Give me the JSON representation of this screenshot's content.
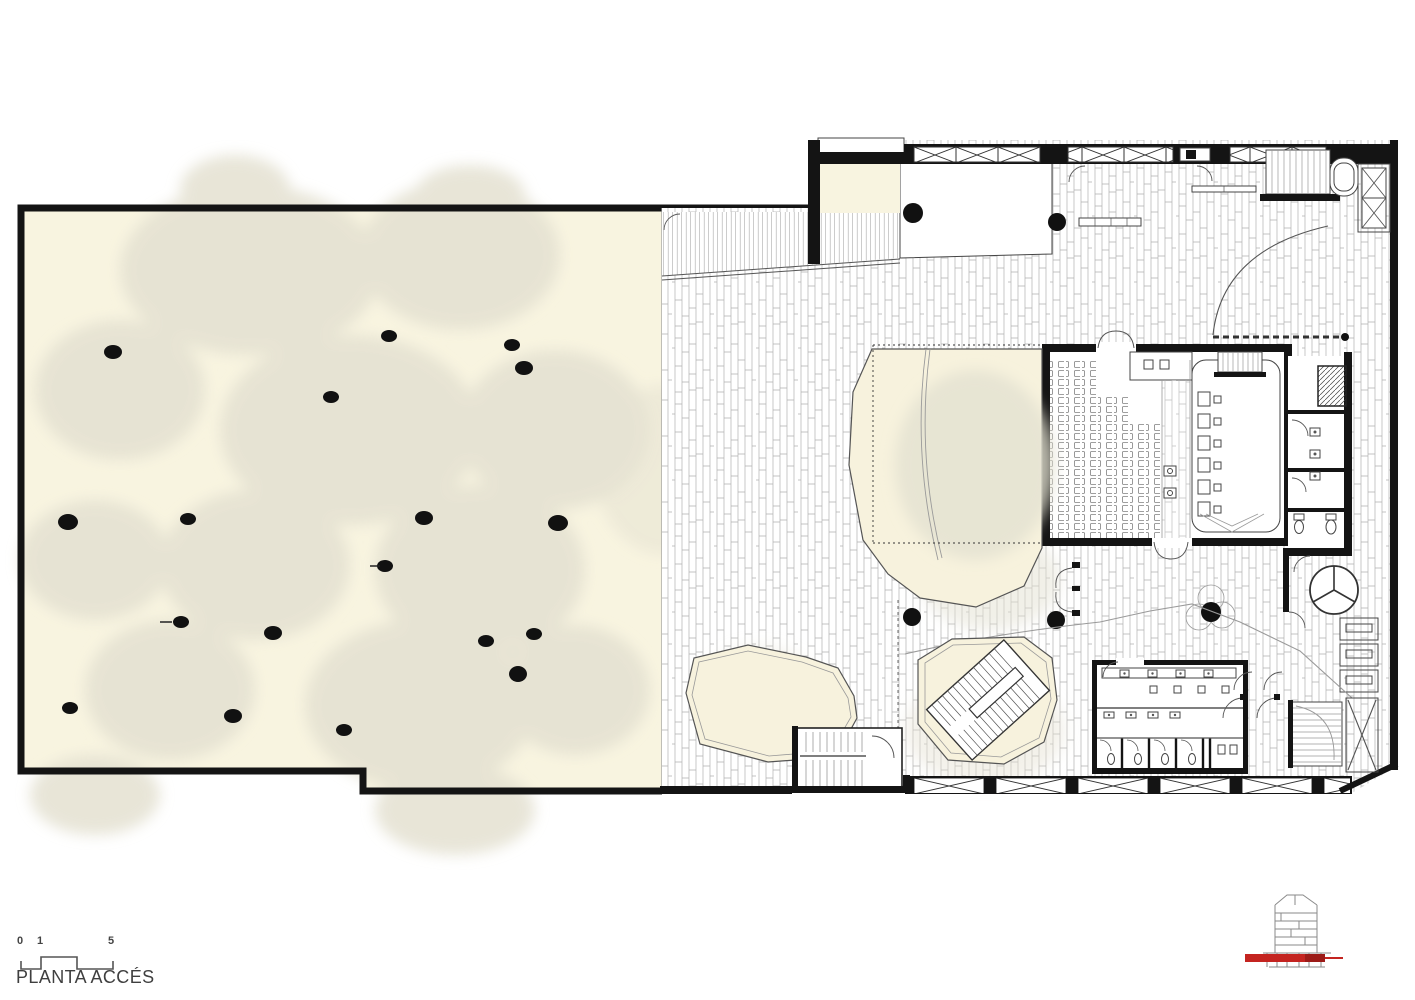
{
  "document": {
    "title": "PLANTA ACCÉS",
    "scale_bar": {
      "tick_labels": [
        "0",
        "1",
        "5"
      ]
    }
  },
  "colors": {
    "paper": "#ffffff",
    "plaza_fill": "#f8f4e0",
    "courtyard_fill": "#f7f2dd",
    "tree_canopy": "#e4e1d1",
    "wall": "#141414",
    "line_medium": "#555555",
    "line_light": "#9a9a9a",
    "section_marker_red": "#c42420"
  },
  "icons": {
    "section_level_indicator": "building-section-level-indicator-icon",
    "tree_symbol": "tree-plan-symbol",
    "column_symbol": "structural-column-dot"
  }
}
